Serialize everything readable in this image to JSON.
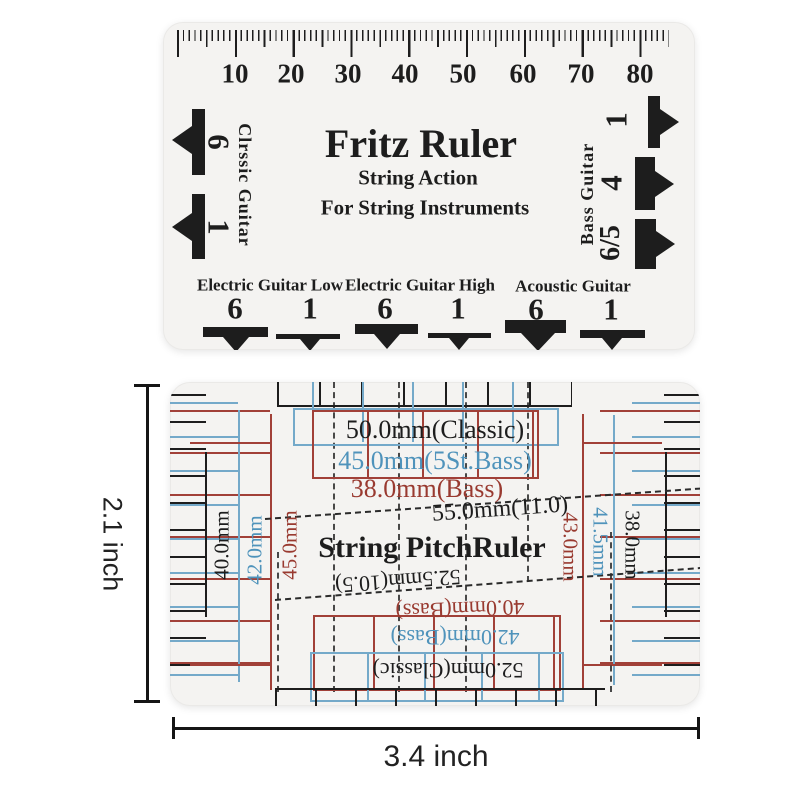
{
  "top_ruler": {
    "title": "Fritz Ruler",
    "subtitle1": "String Action",
    "subtitle2": "For String Instruments",
    "scale": [
      "10",
      "20",
      "30",
      "40",
      "50",
      "60",
      "70",
      "80"
    ],
    "left": {
      "label": "Clrssic Guitar",
      "markers": [
        "6",
        "1"
      ]
    },
    "right": {
      "label": "Bass Guitar",
      "markers": [
        "1",
        "4",
        "6/5"
      ]
    },
    "bottom_groups": [
      {
        "label": "Electric Guitar Low",
        "positions": [
          "6",
          "1"
        ]
      },
      {
        "label": "Electric Guitar High",
        "positions": [
          "6",
          "1"
        ]
      },
      {
        "label": "Acoustic Guitar",
        "positions": [
          "6",
          "1"
        ]
      }
    ]
  },
  "bottom_ruler": {
    "title": "String PitchRuler",
    "top_labels": [
      {
        "text": "50.0mm(Classic)",
        "color": "black"
      },
      {
        "text": "45.0mm(5St.Bass)",
        "color": "blue"
      },
      {
        "text": "38.0mm(Bass)",
        "color": "red"
      }
    ],
    "middle_label": "55.0mm(11.0)",
    "inverted_labels": [
      {
        "text": "52.5mm(10.5)",
        "color": "black"
      },
      {
        "text": "40.0mm(Bass)",
        "color": "red"
      },
      {
        "text": "42.0mm(Bass)",
        "color": "blue"
      },
      {
        "text": "52.0mm(Classic)",
        "color": "black"
      }
    ],
    "left_labels": [
      {
        "text": "40.0mm",
        "color": "black"
      },
      {
        "text": "42.0mm",
        "color": "blue"
      },
      {
        "text": "45.0mm",
        "color": "red"
      }
    ],
    "right_labels": [
      {
        "text": "43.0mm",
        "color": "red"
      },
      {
        "text": "41.5mm",
        "color": "blue"
      },
      {
        "text": "38.0mm",
        "color": "black"
      }
    ]
  },
  "dimensions": {
    "height_label": "2.1 inch",
    "width_label": "3.4 inch"
  },
  "colors": {
    "ink": "#1d1d1d",
    "blue": "#4f93bb",
    "red": "#993a30",
    "card": "#f4f3f1"
  }
}
